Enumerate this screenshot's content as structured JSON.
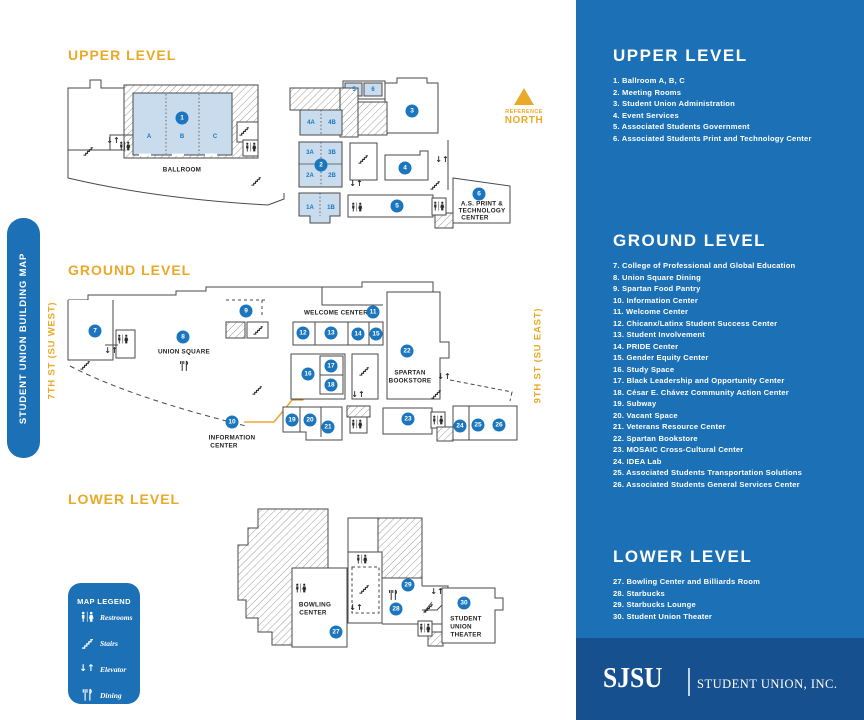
{
  "colors": {
    "panel_blue": "#1c70b6",
    "footer_blue": "#17508f",
    "gold": "#eaa928",
    "marker_blue": "#1b76be",
    "room_fill": "#c9dcee",
    "info_orange": "#f0a636"
  },
  "side_bar": {
    "title": "STUDENT UNION BUILDING MAP"
  },
  "streets": {
    "west": "7TH ST (SU WEST)",
    "east": "9TH ST (SU EAST)"
  },
  "compass": {
    "line1": "REFERENCE",
    "line2": "NORTH"
  },
  "legend": {
    "title": "MAP LEGEND",
    "items": [
      {
        "icon": "restrooms",
        "label": "Restrooms"
      },
      {
        "icon": "stairs",
        "label": "Stairs"
      },
      {
        "icon": "elevator",
        "label": "Elevator"
      },
      {
        "icon": "dining",
        "label": "Dining"
      }
    ]
  },
  "panel": {
    "sections": [
      {
        "id": "upper",
        "heading": "UPPER LEVEL",
        "top": 46,
        "items": [
          "1. Ballroom A, B, C",
          "2. Meeting Rooms",
          "3. Student Union Administration",
          "4. Event Services",
          "5. Associated Students Government",
          "6. Associated Students Print and Technology Center"
        ]
      },
      {
        "id": "ground",
        "heading": "GROUND LEVEL",
        "top": 231,
        "items": [
          "7. College of Professional and Global Education",
          "8. Union Square Dining",
          "9. Spartan Food Pantry",
          "10. Information Center",
          "11. Welcome Center",
          "12. Chicanx/Latinx Student Success Center",
          "13. Student Involvement",
          "14. PRIDE Center",
          "15. Gender Equity Center",
          "16. Study Space",
          "17. Black Leadership and Opportunity Center",
          "18. César E. Chávez Community Action Center",
          "19. Subway",
          "20. Vacant Space",
          "21. Veterans Resource Center",
          "22. Spartan Bookstore",
          "23. MOSAIC Cross-Cultural Center",
          "24. IDEA Lab",
          "25. Associated Students Transportation Solutions",
          "26. Associated Students General Services Center"
        ]
      },
      {
        "id": "lower",
        "heading": "LOWER LEVEL",
        "top": 547,
        "items": [
          "27. Bowling Center and Billiards Room",
          "28. Starbucks",
          "29. Starbucks Lounge",
          "30. Student Union Theater"
        ]
      }
    ]
  },
  "footer": {
    "logo": "SJSU",
    "org": "STUDENT UNION, INC."
  },
  "maps": {
    "upper": {
      "title": "UPPER LEVEL",
      "markers": [
        {
          "n": "1",
          "x": 182,
          "y": 118
        },
        {
          "n": "2",
          "x": 321,
          "y": 165
        },
        {
          "n": "3",
          "x": 412,
          "y": 111
        },
        {
          "n": "4",
          "x": 405,
          "y": 168
        },
        {
          "n": "5",
          "x": 397,
          "y": 206
        },
        {
          "n": "6",
          "x": 479,
          "y": 194
        }
      ],
      "rooms": [
        {
          "t": "A",
          "x": 149,
          "y": 137
        },
        {
          "t": "B",
          "x": 182,
          "y": 137
        },
        {
          "t": "C",
          "x": 215,
          "y": 137
        },
        {
          "t": "5",
          "x": 354,
          "y": 90
        },
        {
          "t": "6",
          "x": 373,
          "y": 90
        },
        {
          "t": "4A",
          "x": 311,
          "y": 123
        },
        {
          "t": "4B",
          "x": 332,
          "y": 123
        },
        {
          "t": "3A",
          "x": 310,
          "y": 153
        },
        {
          "t": "3B",
          "x": 332,
          "y": 153
        },
        {
          "t": "2A",
          "x": 310,
          "y": 176
        },
        {
          "t": "2B",
          "x": 332,
          "y": 176
        },
        {
          "t": "1A",
          "x": 310,
          "y": 208
        },
        {
          "t": "1B",
          "x": 331,
          "y": 208
        }
      ],
      "labels": [
        {
          "t": "BALLROOM",
          "x": 182,
          "y": 170
        },
        {
          "t": "A.S. PRINT &",
          "x": 482,
          "y": 204
        },
        {
          "t": "TECHNOLOGY",
          "x": 482,
          "y": 211
        },
        {
          "t": "CENTER",
          "x": 475,
          "y": 218
        }
      ],
      "icons": [
        {
          "t": "restrooms",
          "x": 125,
          "y": 146
        },
        {
          "t": "restrooms",
          "x": 251,
          "y": 147
        },
        {
          "t": "restrooms",
          "x": 357,
          "y": 207
        },
        {
          "t": "restrooms",
          "x": 439,
          "y": 206
        },
        {
          "t": "stairs",
          "x": 88,
          "y": 151
        },
        {
          "t": "stairs",
          "x": 244,
          "y": 131
        },
        {
          "t": "stairs",
          "x": 256,
          "y": 181
        },
        {
          "t": "stairs",
          "x": 363,
          "y": 159
        },
        {
          "t": "stairs",
          "x": 435,
          "y": 185
        },
        {
          "t": "elevator",
          "x": 113,
          "y": 141
        },
        {
          "t": "elevator",
          "x": 356,
          "y": 184
        },
        {
          "t": "elevator",
          "x": 442,
          "y": 160
        }
      ]
    },
    "ground": {
      "title": "GROUND LEVEL",
      "markers": [
        {
          "n": "7",
          "x": 95,
          "y": 331
        },
        {
          "n": "8",
          "x": 183,
          "y": 337
        },
        {
          "n": "9",
          "x": 246,
          "y": 311
        },
        {
          "n": "10",
          "x": 232,
          "y": 422
        },
        {
          "n": "11",
          "x": 373,
          "y": 312
        },
        {
          "n": "12",
          "x": 303,
          "y": 333
        },
        {
          "n": "13",
          "x": 331,
          "y": 333
        },
        {
          "n": "14",
          "x": 358,
          "y": 334
        },
        {
          "n": "15",
          "x": 376,
          "y": 334
        },
        {
          "n": "16",
          "x": 308,
          "y": 374
        },
        {
          "n": "17",
          "x": 331,
          "y": 366
        },
        {
          "n": "18",
          "x": 331,
          "y": 385
        },
        {
          "n": "19",
          "x": 292,
          "y": 420
        },
        {
          "n": "20",
          "x": 310,
          "y": 420
        },
        {
          "n": "21",
          "x": 328,
          "y": 427
        },
        {
          "n": "22",
          "x": 407,
          "y": 351
        },
        {
          "n": "23",
          "x": 408,
          "y": 419
        },
        {
          "n": "24",
          "x": 460,
          "y": 426
        },
        {
          "n": "25",
          "x": 478,
          "y": 425
        },
        {
          "n": "26",
          "x": 499,
          "y": 425
        }
      ],
      "rooms": [],
      "labels": [
        {
          "t": "UNION SQUARE",
          "x": 184,
          "y": 352
        },
        {
          "t": "WELCOME CENTER",
          "x": 336,
          "y": 313
        },
        {
          "t": "SPARTAN",
          "x": 410,
          "y": 373
        },
        {
          "t": "BOOKSTORE",
          "x": 410,
          "y": 381
        },
        {
          "t": "INFORMATION",
          "x": 232,
          "y": 438
        },
        {
          "t": "CENTER",
          "x": 224,
          "y": 446
        }
      ],
      "icons": [
        {
          "t": "restrooms",
          "x": 123,
          "y": 339
        },
        {
          "t": "restrooms",
          "x": 357,
          "y": 424
        },
        {
          "t": "restrooms",
          "x": 438,
          "y": 420
        },
        {
          "t": "stairs",
          "x": 85,
          "y": 365
        },
        {
          "t": "stairs",
          "x": 258,
          "y": 330
        },
        {
          "t": "stairs",
          "x": 257,
          "y": 390
        },
        {
          "t": "stairs",
          "x": 364,
          "y": 371
        },
        {
          "t": "stairs",
          "x": 436,
          "y": 394
        },
        {
          "t": "elevator",
          "x": 111,
          "y": 351
        },
        {
          "t": "elevator",
          "x": 358,
          "y": 395
        },
        {
          "t": "elevator",
          "x": 444,
          "y": 377
        },
        {
          "t": "dining",
          "x": 184,
          "y": 366
        }
      ]
    },
    "lower": {
      "title": "LOWER LEVEL",
      "markers": [
        {
          "n": "27",
          "x": 336,
          "y": 632
        },
        {
          "n": "28",
          "x": 396,
          "y": 609
        },
        {
          "n": "29",
          "x": 408,
          "y": 585
        },
        {
          "n": "30",
          "x": 464,
          "y": 603
        }
      ],
      "rooms": [],
      "labels": [
        {
          "t": "BOWLING",
          "x": 315,
          "y": 605
        },
        {
          "t": "CENTER",
          "x": 313,
          "y": 613
        },
        {
          "t": "STUDENT",
          "x": 466,
          "y": 619
        },
        {
          "t": "UNION",
          "x": 461,
          "y": 627
        },
        {
          "t": "THEATER",
          "x": 466,
          "y": 635
        }
      ],
      "icons": [
        {
          "t": "restrooms",
          "x": 301,
          "y": 588
        },
        {
          "t": "restrooms",
          "x": 362,
          "y": 559
        },
        {
          "t": "restrooms",
          "x": 425,
          "y": 628
        },
        {
          "t": "stairs",
          "x": 364,
          "y": 589
        },
        {
          "t": "stairs",
          "x": 428,
          "y": 608
        },
        {
          "t": "elevator",
          "x": 356,
          "y": 608
        },
        {
          "t": "elevator",
          "x": 437,
          "y": 592
        },
        {
          "t": "dining",
          "x": 393,
          "y": 595
        }
      ]
    }
  }
}
